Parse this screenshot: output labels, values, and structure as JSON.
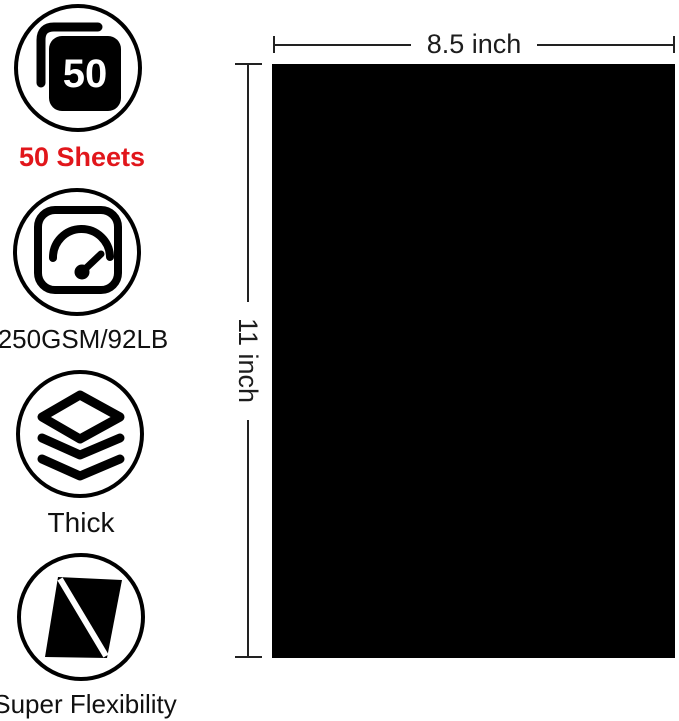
{
  "features": [
    {
      "name": "sheet-count",
      "icon": "sheet-stack-icon",
      "count": "50",
      "label": "50 Sheets"
    },
    {
      "name": "paper-weight",
      "icon": "gauge-icon",
      "label": "250GSM/92LB"
    },
    {
      "name": "thickness",
      "icon": "layers-icon",
      "label": "Thick"
    },
    {
      "name": "flexibility",
      "icon": "bent-sheet-icon",
      "label": "Super Flexibility"
    }
  ],
  "paper": {
    "width_label": "8.5 inch",
    "height_label": "11 inch",
    "color": "#000000"
  },
  "colors": {
    "highlight_red": "#e1161b",
    "ink": "#1a1a1a"
  }
}
